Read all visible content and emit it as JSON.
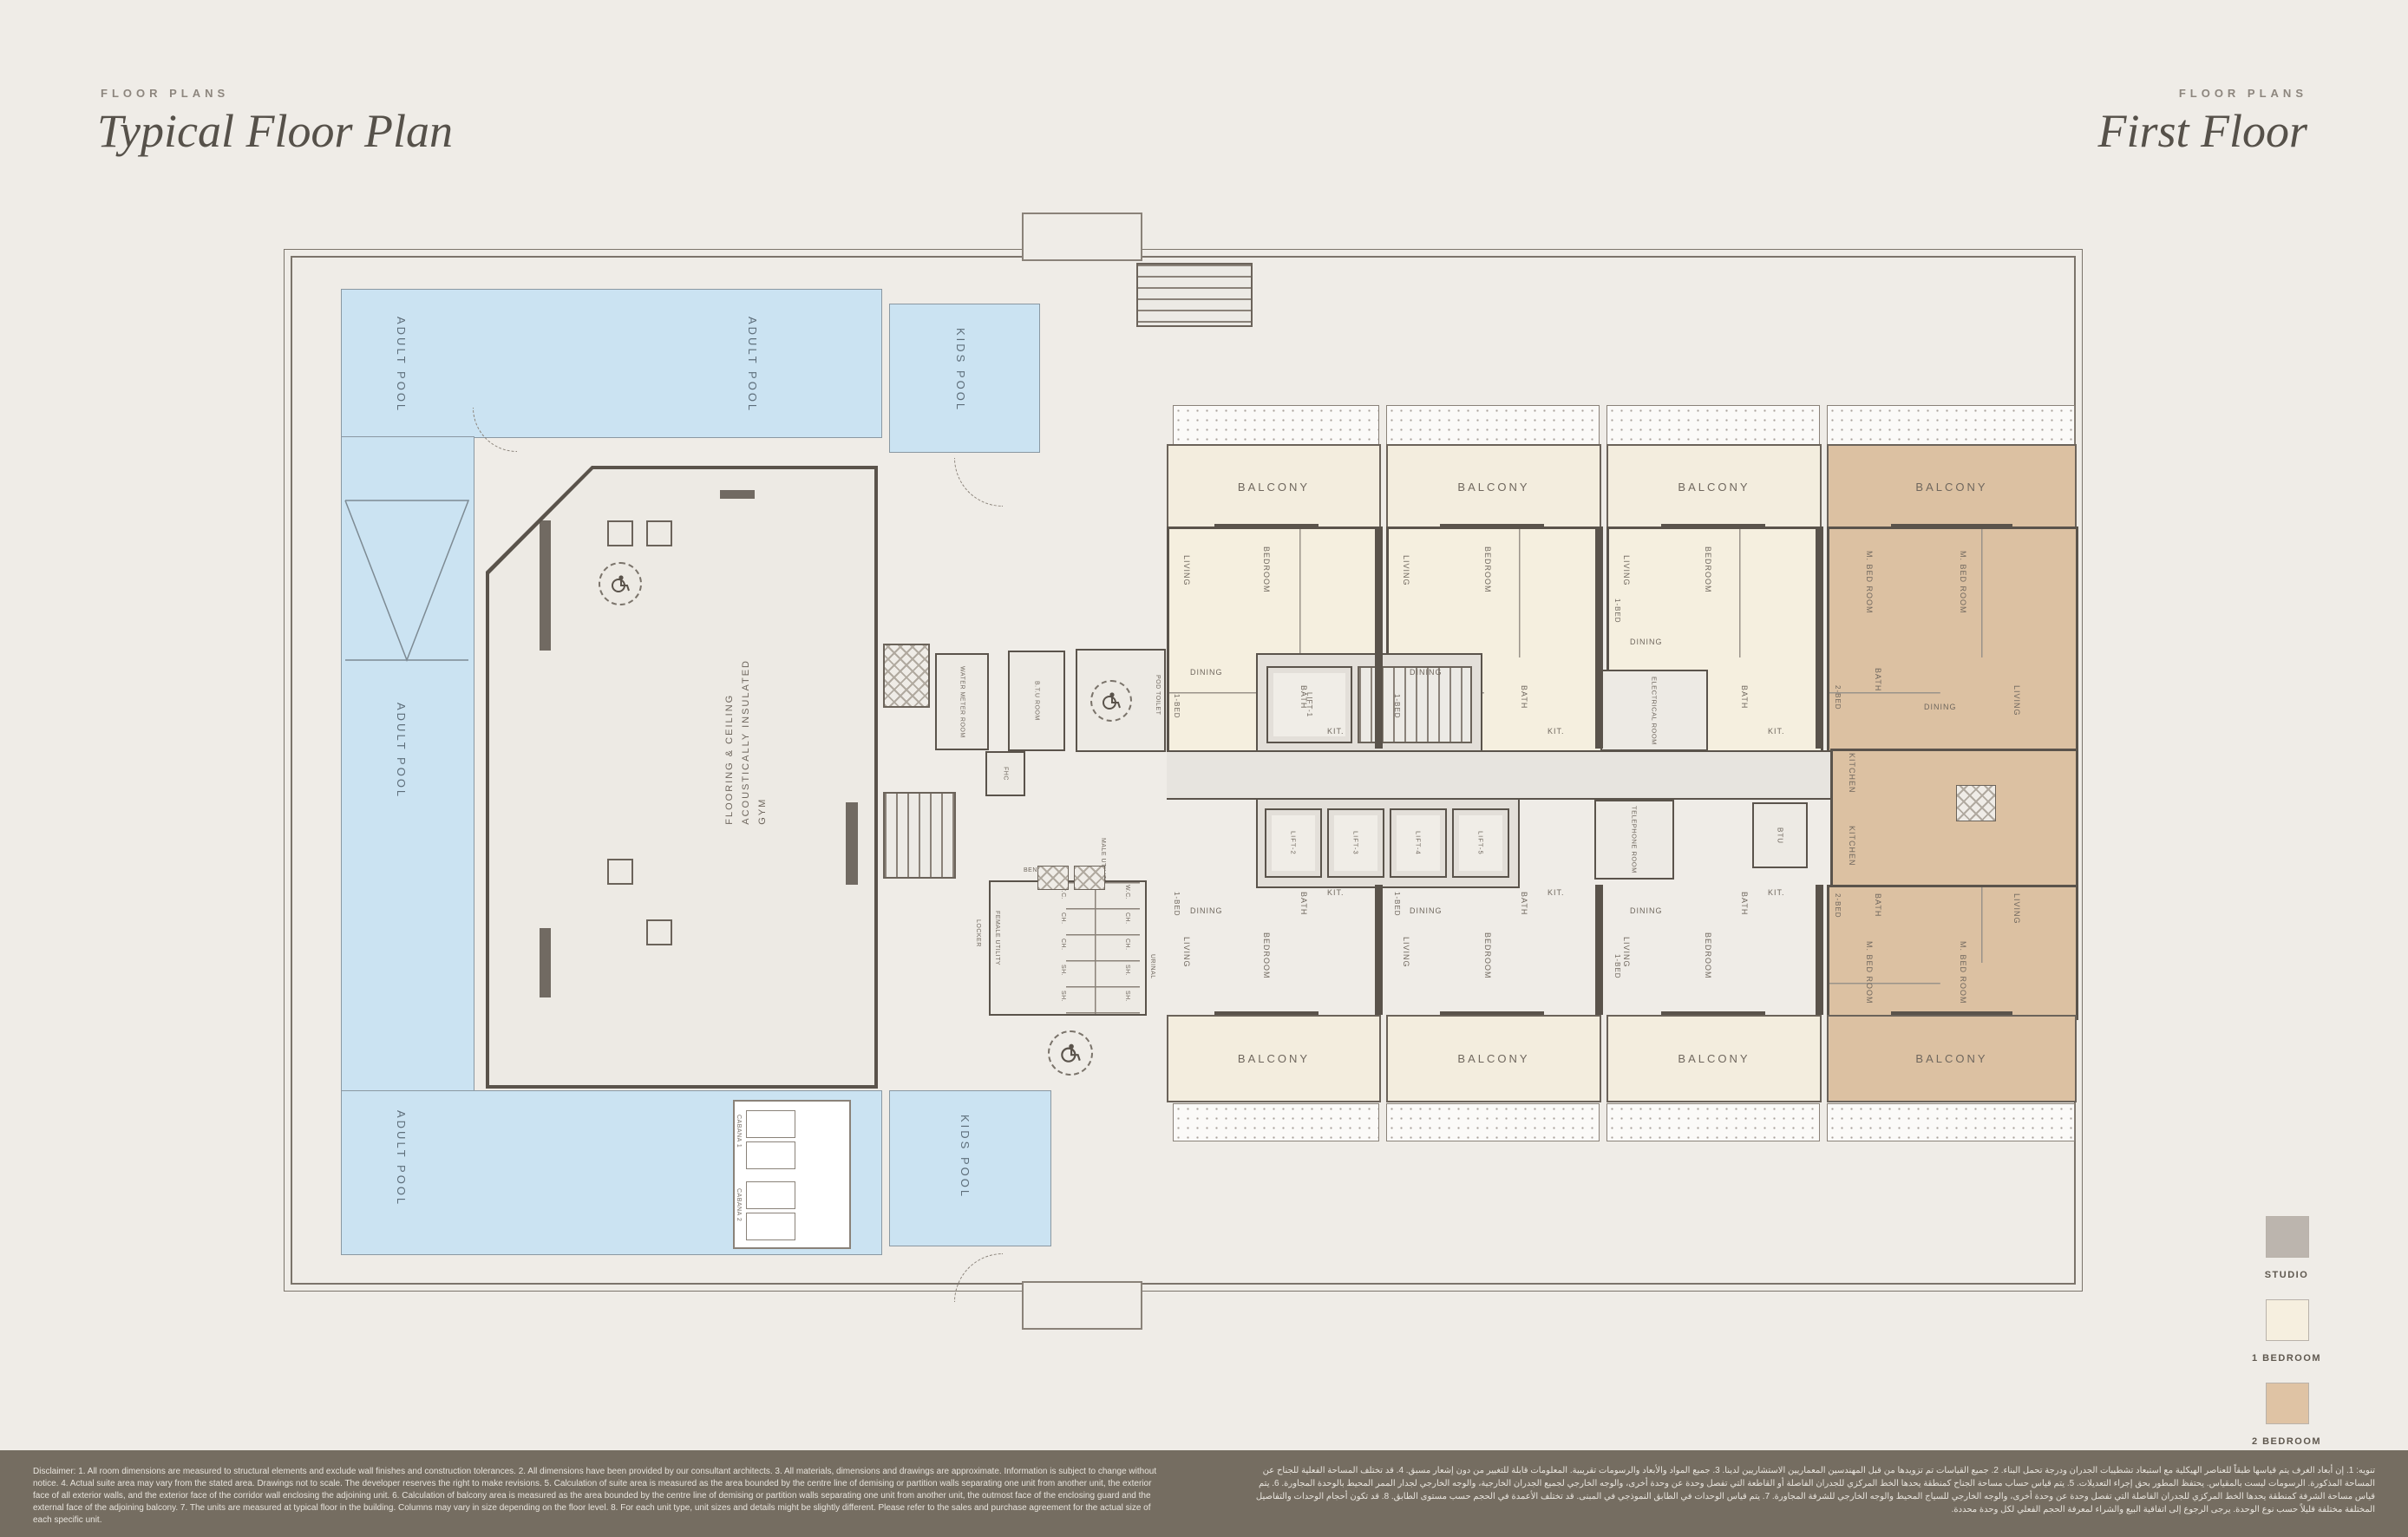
{
  "header": {
    "left": {
      "eyebrow": "FLOOR PLANS",
      "title": "Typical Floor Plan"
    },
    "right": {
      "eyebrow": "FLOOR PLANS",
      "title": "First Floor"
    }
  },
  "legend": {
    "items": [
      {
        "label": "STUDIO",
        "color": "#bcb5ae"
      },
      {
        "label": "1 BEDROOM",
        "color": "#f6efdf"
      },
      {
        "label": "2 BEDROOM",
        "color": "#dfc3a4"
      }
    ]
  },
  "plan": {
    "pools": {
      "adult_pool": "ADULT POOL",
      "kids_pool": "KIDS POOL",
      "cabana1": "CABANA 1",
      "cabana2": "CABANA 2"
    },
    "gym": {
      "line1": "GYM",
      "line2": "ACOUSTICALLY INSULATED",
      "line3": "FLOORING & CEILING"
    },
    "balcony_label": "BALCONY",
    "lifts": {
      "l1": "LIFT-1",
      "l2": "LIFT-2",
      "l3": "LIFT-3",
      "l4": "LIFT-4",
      "l5": "LIFT-5"
    },
    "rooms": {
      "living": "LIVING",
      "dining": "DINING",
      "bedroom": "BEDROOM",
      "m_bedroom": "M. BED ROOM",
      "bath": "BATH",
      "kit": "KIT.",
      "kitchen": "KITCHEN",
      "one_bed": "1-BED",
      "two_bed": "2-BED",
      "electrical": "ELECTRICAL ROOM",
      "telephone": "TELEPHONE ROOM",
      "btu": "BTU",
      "btu_room": "B.T.U ROOM",
      "water_meter": "WATER METER ROOM",
      "fhc": "FHC",
      "pod_toilet": "POD TOILET",
      "female_utility": "FEMALE UTILITY",
      "male_utility": "MALE UTILITY",
      "urinal": "URINAL",
      "bench": "BENCH",
      "locker": "LOCKER",
      "wc": "W.C.",
      "ch": "CH.",
      "sh": "SH."
    }
  },
  "footer": {
    "disclaimer_en": "Disclaimer: 1. All room dimensions are measured to structural elements and exclude wall finishes and construction tolerances. 2. All dimensions have been provided by our consultant architects. 3. All materials, dimensions and drawings are approximate. Information is subject to change without notice. 4. Actual suite area may vary from the stated area. Drawings not to scale. The developer reserves the right to make revisions. 5. Calculation of suite area is measured as the area bounded by the centre line of demising or partition walls separating one unit from another unit, the exterior face of all exterior walls, and the exterior face of the corridor wall enclosing the adjoining unit. 6. Calculation of balcony area is measured as the area bounded by the centre line of demising or partition walls separating one unit from another unit, the outmost face of the enclosing guard and the external face of the adjoining balcony. 7. The units are measured at typical floor in the building. Columns may vary in size depending on the floor level. 8. For each unit type, unit sizes and details might be slightly different. Please refer to the sales and purchase agreement for the actual size of each specific unit.",
    "disclaimer_ar": "تنويه: 1. إن أبعاد الغرف يتم قياسها طبقاً للعناصر الهيكلية مع استبعاد تشطيبات الجدران ودرجة تحمل البناء. 2. جميع القياسات تم تزويدها من قبل المهندسين المعماريين الاستشاريين لدينا. 3. جميع المواد والأبعاد والرسومات تقريبية. المعلومات قابلة للتغيير من دون إشعار مسبق. 4. قد تختلف المساحة الفعلية للجناح عن المساحة المذكورة. الرسومات ليست بالمقياس. يحتفظ المطور بحق إجراء التعديلات. 5. يتم قياس حساب مساحة الجناح كمنطقة يحدها الخط المركزي للجدران الفاصلة أو القاطعة التي تفصل وحدة عن وحدة أخرى، والوجه الخارجي لجميع الجدران الخارجية، والوجه الخارجي لجدار الممر المحيط بالوحدة المجاورة. 6. يتم قياس مساحة الشرفة كمنطقة يحدها الخط المركزي للجدران الفاصلة التي تفصل وحدة عن وحدة أخرى، والوجه الخارجي للسياج المحيط والوجه الخارجي للشرفة المجاورة. 7. يتم قياس الوحدات في الطابق النموذجي في المبنى. قد تختلف الأعمدة في الحجم حسب مستوى الطابق. 8. قد تكون أحجام الوحدات والتفاصيل المختلفة مختلفة قليلاً حسب نوع الوحدة. يرجى الرجوع إلى اتفاقية البيع والشراء لمعرفة الحجم الفعلي لكل وحدة محددة."
  }
}
